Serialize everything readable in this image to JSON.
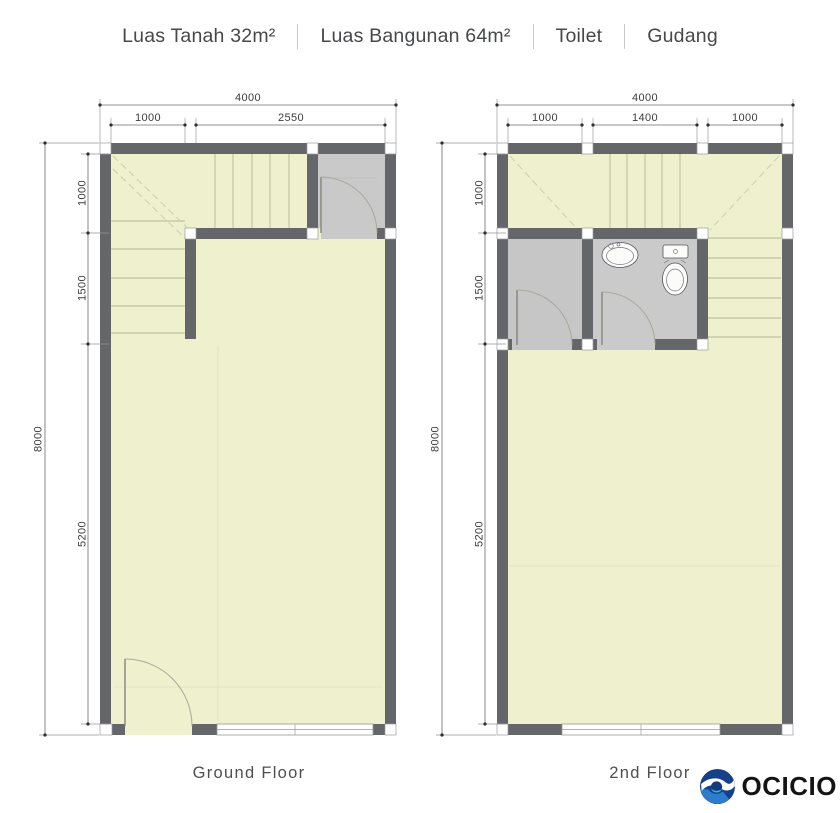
{
  "title": {
    "items": [
      "Luas Tanah 32m²",
      "Luas Bangunan 64m²",
      "Toilet",
      "Gudang"
    ]
  },
  "plans": {
    "ground": {
      "label": "Ground Floor",
      "top_total": "4000",
      "top_segs": [
        "1000",
        "2550"
      ],
      "left_total": "8000",
      "left_segs": [
        "1000",
        "1500",
        "5200"
      ]
    },
    "second": {
      "label": "2nd Floor",
      "top_total": "4000",
      "top_segs": [
        "1000",
        "1400",
        "1000"
      ],
      "left_total": "8000",
      "left_segs": [
        "1000",
        "1500",
        "5200"
      ]
    }
  },
  "logo": {
    "text": "OCICIO"
  },
  "colors": {
    "floor": "#eff0ce",
    "wall": "#64666a",
    "wet_room": "#c7c7c8",
    "logo_navy": "#15418a",
    "logo_blue": "#2e7ccc",
    "logo_cyan": "#35b6d9"
  }
}
